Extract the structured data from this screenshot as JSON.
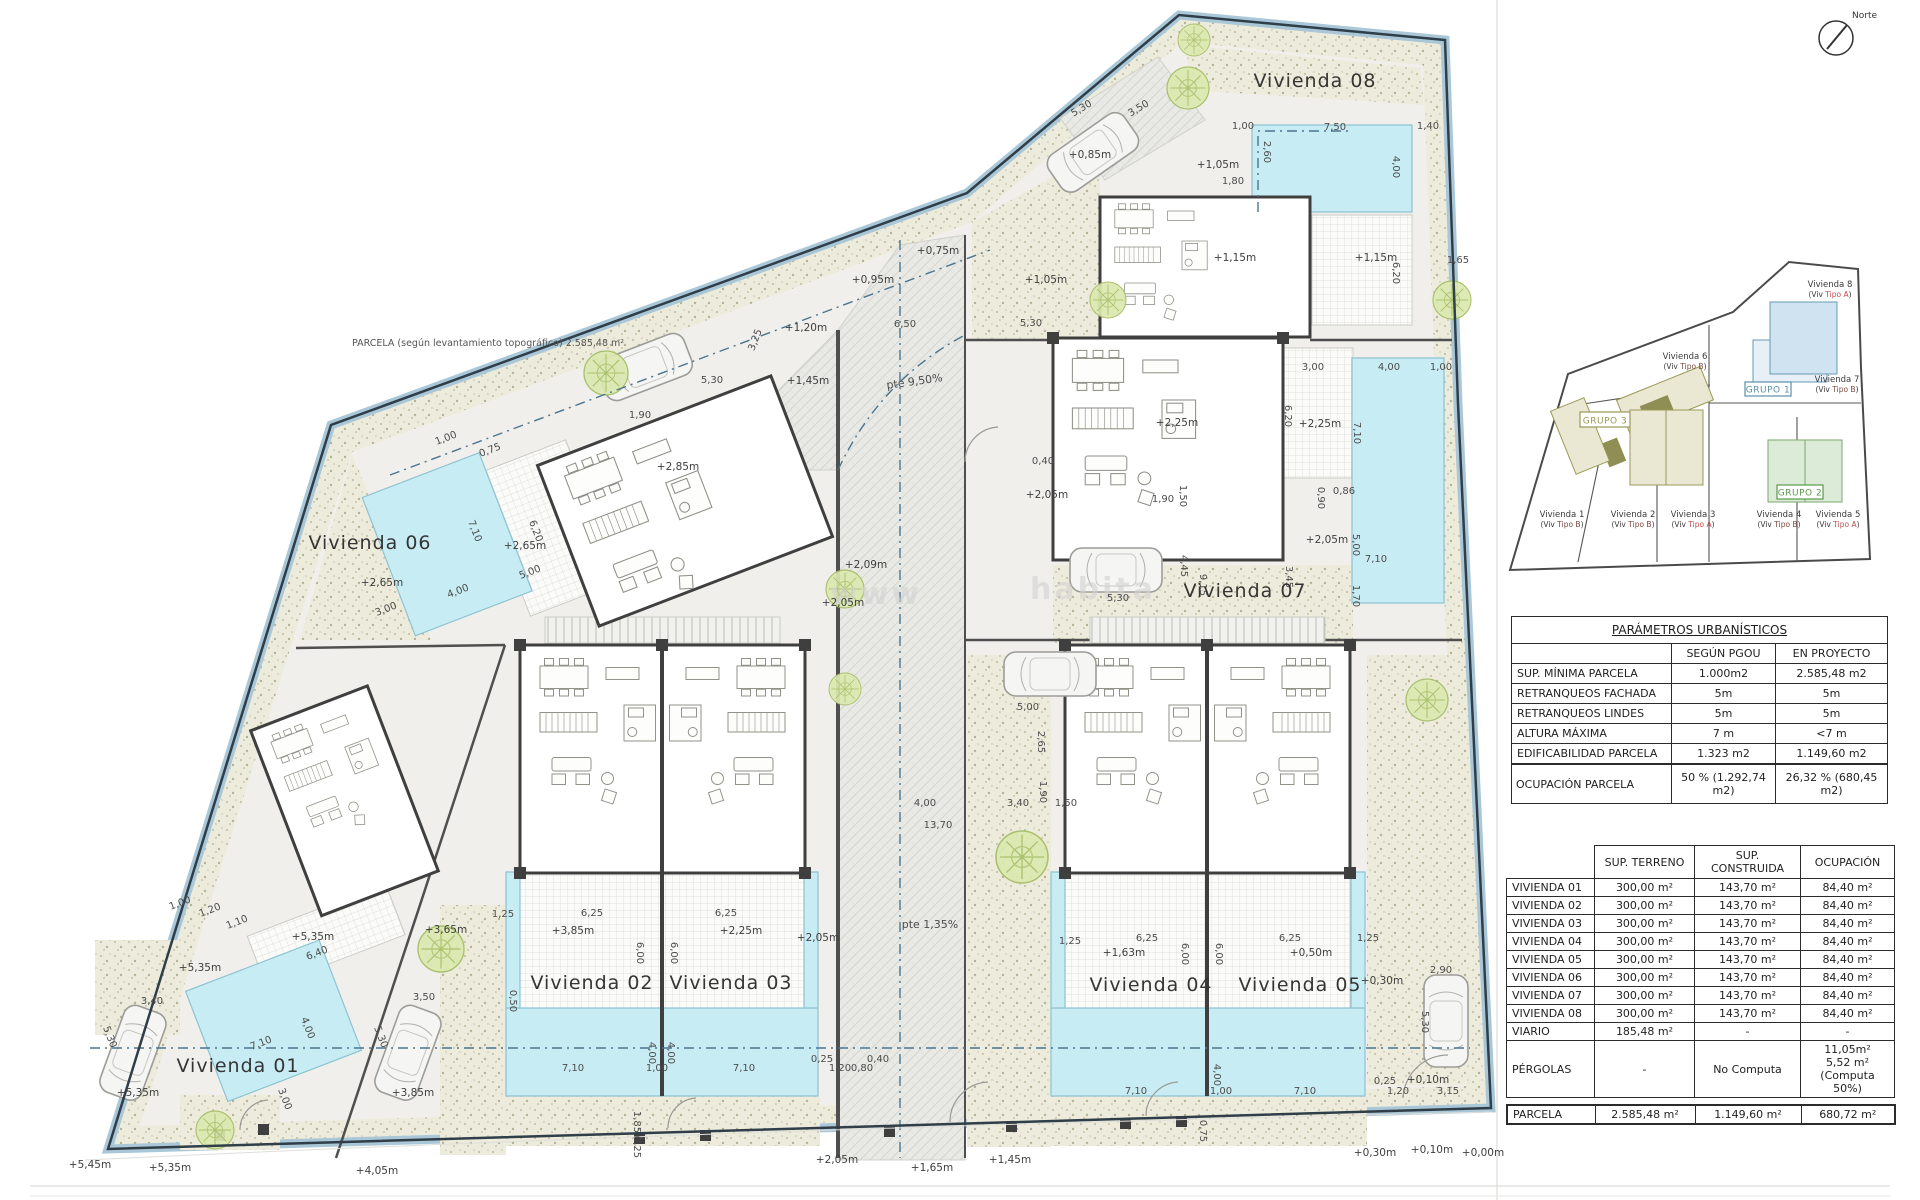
{
  "site_plan": {
    "note_parcela": "PARCELA (según levantamiento topográfico) 2.585,48 m²",
    "north_label": "Norte",
    "watermark_fragments": [
      {
        "t": "www",
        "x": 830,
        "y": 604
      },
      {
        "t": "habita",
        "x": 1030,
        "y": 599
      }
    ],
    "unit_labels": [
      {
        "t": "Vivienda 01",
        "x": 238,
        "y": 1072
      },
      {
        "t": "Vivienda 02",
        "x": 592,
        "y": 989
      },
      {
        "t": "Vivienda 03",
        "x": 731,
        "y": 989
      },
      {
        "t": "Vivienda 04",
        "x": 1151,
        "y": 991
      },
      {
        "t": "Vivienda 05",
        "x": 1300,
        "y": 991
      },
      {
        "t": "Vivienda 06",
        "x": 370,
        "y": 549
      },
      {
        "t": "Vivienda 07",
        "x": 1245,
        "y": 597
      },
      {
        "t": "Vivienda 08",
        "x": 1315,
        "y": 87
      }
    ],
    "slope_labels": [
      {
        "t": "pte 9,50%",
        "x": 915,
        "y": 385,
        "r": -8
      },
      {
        "t": "pte 1,35%",
        "x": 930,
        "y": 928
      }
    ],
    "elevation_labels": [
      {
        "t": "+2,65m",
        "x": 382,
        "y": 586
      },
      {
        "t": "+2,65m",
        "x": 525,
        "y": 549
      },
      {
        "t": "+2,85m",
        "x": 678,
        "y": 470
      },
      {
        "t": "+1,20m",
        "x": 806,
        "y": 331
      },
      {
        "t": "+1,45m",
        "x": 808,
        "y": 384
      },
      {
        "t": "+0,75m",
        "x": 938,
        "y": 254
      },
      {
        "t": "+0,95m",
        "x": 873,
        "y": 283
      },
      {
        "t": "+1,05m",
        "x": 1046,
        "y": 283
      },
      {
        "t": "+1,05m",
        "x": 1218,
        "y": 168
      },
      {
        "t": "+0,85m",
        "x": 1090,
        "y": 158
      },
      {
        "t": "+1,15m",
        "x": 1235,
        "y": 261
      },
      {
        "t": "+1,15m",
        "x": 1376,
        "y": 261
      },
      {
        "t": "+2,25m",
        "x": 1177,
        "y": 426
      },
      {
        "t": "+2,25m",
        "x": 1320,
        "y": 427
      },
      {
        "t": "+2,05m",
        "x": 1047,
        "y": 498
      },
      {
        "t": "+2,05m",
        "x": 1327,
        "y": 543
      },
      {
        "t": "+2,09m",
        "x": 866,
        "y": 568
      },
      {
        "t": "+2,05m",
        "x": 843,
        "y": 606
      },
      {
        "t": "+3,85m",
        "x": 573,
        "y": 934
      },
      {
        "t": "+2,25m",
        "x": 741,
        "y": 934
      },
      {
        "t": "+2,05m",
        "x": 818,
        "y": 941
      },
      {
        "t": "+3,65m",
        "x": 446,
        "y": 933
      },
      {
        "t": "+1,63m",
        "x": 1124,
        "y": 956
      },
      {
        "t": "+0,50m",
        "x": 1311,
        "y": 956
      },
      {
        "t": "+0,30m",
        "x": 1382,
        "y": 984
      },
      {
        "t": "+0,10m",
        "x": 1428,
        "y": 1083
      },
      {
        "t": "+0,30m",
        "x": 1375,
        "y": 1156
      },
      {
        "t": "+0,10m",
        "x": 1432,
        "y": 1153
      },
      {
        "t": "+0,00m",
        "x": 1483,
        "y": 1156
      },
      {
        "t": "+5,35m",
        "x": 200,
        "y": 971
      },
      {
        "t": "+5,35m",
        "x": 313,
        "y": 940
      },
      {
        "t": "+5,35m",
        "x": 138,
        "y": 1096
      },
      {
        "t": "+3,85m",
        "x": 413,
        "y": 1096
      },
      {
        "t": "+5,45m",
        "x": 90,
        "y": 1168
      },
      {
        "t": "+5,35m",
        "x": 170,
        "y": 1171
      },
      {
        "t": "+4,05m",
        "x": 377,
        "y": 1174
      },
      {
        "t": "+2,05m",
        "x": 837,
        "y": 1163
      },
      {
        "t": "+1,65m",
        "x": 932,
        "y": 1171
      },
      {
        "t": "+1,45m",
        "x": 1010,
        "y": 1163
      }
    ],
    "dimension_labels": [
      {
        "t": "7,10",
        "x": 472,
        "y": 532,
        "r": 69
      },
      {
        "t": "6,20",
        "x": 533,
        "y": 532,
        "r": 69
      },
      {
        "t": "4,00",
        "x": 459,
        "y": 594,
        "r": -21
      },
      {
        "t": "3,00",
        "x": 387,
        "y": 612,
        "r": -21
      },
      {
        "t": "5,00",
        "x": 531,
        "y": 575,
        "r": -21
      },
      {
        "t": "1,00",
        "x": 447,
        "y": 441,
        "r": -21
      },
      {
        "t": "0,75",
        "x": 491,
        "y": 453,
        "r": -21
      },
      {
        "t": "5,30",
        "x": 712,
        "y": 383
      },
      {
        "t": "3,25",
        "x": 758,
        "y": 341,
        "r": -69
      },
      {
        "t": "1,90",
        "x": 640,
        "y": 418
      },
      {
        "t": "6,50",
        "x": 905,
        "y": 327
      },
      {
        "t": "5,30",
        "x": 1031,
        "y": 326
      },
      {
        "t": "5,00",
        "x": 1028,
        "y": 710
      },
      {
        "t": "2,65",
        "x": 1038,
        "y": 742,
        "r": 90
      },
      {
        "t": "1,90",
        "x": 1040,
        "y": 792,
        "r": 90
      },
      {
        "t": "3,40",
        "x": 1018,
        "y": 806
      },
      {
        "t": "1,50",
        "x": 1066,
        "y": 806
      },
      {
        "t": "4,00",
        "x": 925,
        "y": 806
      },
      {
        "t": "13,70",
        "x": 938,
        "y": 828
      },
      {
        "t": "1,25",
        "x": 1070,
        "y": 944
      },
      {
        "t": "1,25",
        "x": 503,
        "y": 917
      },
      {
        "t": "6,25",
        "x": 592,
        "y": 916
      },
      {
        "t": "6,25",
        "x": 726,
        "y": 916
      },
      {
        "t": "6,00",
        "x": 637,
        "y": 953,
        "r": 90
      },
      {
        "t": "6,00",
        "x": 671,
        "y": 953,
        "r": 90
      },
      {
        "t": "0,50",
        "x": 510,
        "y": 1001,
        "r": 90
      },
      {
        "t": "7,10",
        "x": 573,
        "y": 1071
      },
      {
        "t": "7,10",
        "x": 744,
        "y": 1071
      },
      {
        "t": "1,00",
        "x": 657,
        "y": 1071
      },
      {
        "t": "4,00",
        "x": 649,
        "y": 1053,
        "r": 90
      },
      {
        "t": "4,00",
        "x": 668,
        "y": 1053,
        "r": 90
      },
      {
        "t": "0,25",
        "x": 822,
        "y": 1062
      },
      {
        "t": "1,20",
        "x": 840,
        "y": 1071
      },
      {
        "t": "0,80",
        "x": 862,
        "y": 1071
      },
      {
        "t": "0,40",
        "x": 878,
        "y": 1062
      },
      {
        "t": "1,85",
        "x": 634,
        "y": 1122,
        "r": 90
      },
      {
        "t": "0,25",
        "x": 634,
        "y": 1147,
        "r": 90
      },
      {
        "t": "6,25",
        "x": 1147,
        "y": 941
      },
      {
        "t": "6,25",
        "x": 1290,
        "y": 941
      },
      {
        "t": "1,25",
        "x": 1368,
        "y": 941
      },
      {
        "t": "6,00",
        "x": 1182,
        "y": 954,
        "r": 90
      },
      {
        "t": "6,00",
        "x": 1216,
        "y": 954,
        "r": 90
      },
      {
        "t": "7,10",
        "x": 1136,
        "y": 1094
      },
      {
        "t": "7,10",
        "x": 1305,
        "y": 1094
      },
      {
        "t": "1,00",
        "x": 1221,
        "y": 1094
      },
      {
        "t": "4,00",
        "x": 1214,
        "y": 1075,
        "r": 90
      },
      {
        "t": "0,25",
        "x": 1385,
        "y": 1084
      },
      {
        "t": "1,20",
        "x": 1398,
        "y": 1094
      },
      {
        "t": "3,15",
        "x": 1448,
        "y": 1094
      },
      {
        "t": "2,90",
        "x": 1441,
        "y": 973
      },
      {
        "t": "5,30",
        "x": 1422,
        "y": 1022,
        "r": 90
      },
      {
        "t": "0,75",
        "x": 1200,
        "y": 1131,
        "r": 90
      },
      {
        "t": "3,40",
        "x": 152,
        "y": 1004
      },
      {
        "t": "5,30",
        "x": 107,
        "y": 1038,
        "r": 69
      },
      {
        "t": "5,30",
        "x": 378,
        "y": 1038,
        "r": 69
      },
      {
        "t": "3,50",
        "x": 424,
        "y": 1000
      },
      {
        "t": "7,10",
        "x": 262,
        "y": 1046,
        "r": -21
      },
      {
        "t": "4,00",
        "x": 305,
        "y": 1029,
        "r": 69
      },
      {
        "t": "3,00",
        "x": 282,
        "y": 1100,
        "r": 69
      },
      {
        "t": "6,40",
        "x": 318,
        "y": 956,
        "r": -21
      },
      {
        "t": "1,20",
        "x": 211,
        "y": 913,
        "r": -21
      },
      {
        "t": "1,00",
        "x": 181,
        "y": 906,
        "r": -21
      },
      {
        "t": "1,10",
        "x": 238,
        "y": 925,
        "r": -21
      },
      {
        "t": "3,00",
        "x": 1313,
        "y": 370
      },
      {
        "t": "4,00",
        "x": 1389,
        "y": 370
      },
      {
        "t": "1,00",
        "x": 1441,
        "y": 370
      },
      {
        "t": "6,20",
        "x": 1285,
        "y": 416,
        "r": 90
      },
      {
        "t": "7,10",
        "x": 1354,
        "y": 433,
        "r": 90
      },
      {
        "t": "0,40",
        "x": 1043,
        "y": 464
      },
      {
        "t": "1,90",
        "x": 1163,
        "y": 502
      },
      {
        "t": "1,50",
        "x": 1180,
        "y": 496,
        "r": 90
      },
      {
        "t": "0,90",
        "x": 1318,
        "y": 498,
        "r": 90
      },
      {
        "t": "0,86",
        "x": 1344,
        "y": 494
      },
      {
        "t": "5,00",
        "x": 1353,
        "y": 545,
        "r": 90
      },
      {
        "t": "7,10",
        "x": 1376,
        "y": 562
      },
      {
        "t": "4,45",
        "x": 1181,
        "y": 566,
        "r": 90
      },
      {
        "t": "9,15",
        "x": 1200,
        "y": 585,
        "r": 90
      },
      {
        "t": "3,45",
        "x": 1286,
        "y": 577,
        "r": 90
      },
      {
        "t": "5,30",
        "x": 1118,
        "y": 601
      },
      {
        "t": "1,70",
        "x": 1353,
        "y": 596,
        "r": 90
      },
      {
        "t": "5,30",
        "x": 1083,
        "y": 111,
        "r": -31
      },
      {
        "t": "3,50",
        "x": 1140,
        "y": 111,
        "r": -31
      },
      {
        "t": "1,00",
        "x": 1243,
        "y": 129
      },
      {
        "t": "7,50",
        "x": 1335,
        "y": 130
      },
      {
        "t": "1,40",
        "x": 1428,
        "y": 129
      },
      {
        "t": "2,60",
        "x": 1264,
        "y": 152,
        "r": 90
      },
      {
        "t": "4,00",
        "x": 1393,
        "y": 167,
        "r": 90
      },
      {
        "t": "1,80",
        "x": 1233,
        "y": 184
      },
      {
        "t": "6,20",
        "x": 1393,
        "y": 273,
        "r": 90
      },
      {
        "t": "1,65",
        "x": 1458,
        "y": 263
      }
    ]
  },
  "key_plan": {
    "tipo_a_color": "#c0504d",
    "tipo_b_color": "#7a4a42",
    "groups": [
      {
        "label": "GRUPO 1",
        "x": 245,
        "y": 130,
        "w": 46,
        "h": 14,
        "color": "#5b8fa8"
      },
      {
        "label": "GRUPO 2",
        "x": 277,
        "y": 233,
        "w": 46,
        "h": 14,
        "color": "#589a4a"
      },
      {
        "label": "GRUPO 3",
        "x": 80,
        "y": 160,
        "w": 50,
        "h": 15,
        "color": "#9a9a57"
      }
    ],
    "units": [
      {
        "name": "Vivienda 1",
        "tipo": "Tipo B",
        "x": 62,
        "y": 265
      },
      {
        "name": "Vivienda 2",
        "tipo": "Tipo B",
        "x": 133,
        "y": 265
      },
      {
        "name": "Vivienda 3",
        "tipo": "Tipo A",
        "x": 193,
        "y": 265
      },
      {
        "name": "Vivienda 4",
        "tipo": "Tipo B",
        "x": 279,
        "y": 265
      },
      {
        "name": "Vivienda 5",
        "tipo": "Tipo A",
        "x": 338,
        "y": 265
      },
      {
        "name": "Vivienda 6",
        "tipo": "Tipo B",
        "x": 185,
        "y": 107
      },
      {
        "name": "Vivienda 7",
        "tipo": "Tipo B",
        "x": 337,
        "y": 130
      },
      {
        "name": "Vivienda 8",
        "tipo": "Tipo A",
        "x": 330,
        "y": 35
      }
    ]
  },
  "params_table": {
    "title": "PARÁMETROS URBANÍSTICOS",
    "col_headers": [
      "SEGÚN PGOU",
      "EN PROYECTO"
    ],
    "rows": [
      [
        "SUP. MÍNIMA PARCELA",
        "1.000m2",
        "2.585,48 m2"
      ],
      [
        "RETRANQUEOS FACHADA",
        "5m",
        "5m"
      ],
      [
        "RETRANQUEOS LINDES",
        "5m",
        "5m"
      ],
      [
        "ALTURA MÁXIMA",
        "7 m",
        "<7 m"
      ],
      [
        "EDIFICABILIDAD PARCELA",
        "1.323 m2",
        "1.149,60 m2"
      ]
    ],
    "footer_rows": [
      [
        "OCUPACIÓN PARCELA",
        "50 % (1.292,74 m2)",
        "26,32 % (680,45 m2)"
      ]
    ]
  },
  "areas_table": {
    "col_headers": [
      "SUP. TERRENO",
      "SUP. CONSTRUIDA",
      "OCUPACIÓN"
    ],
    "rows": [
      [
        "VIVIENDA 01",
        "300,00 m²",
        "143,70 m²",
        "84,40 m²"
      ],
      [
        "VIVIENDA 02",
        "300,00 m²",
        "143,70 m²",
        "84,40 m²"
      ],
      [
        "VIVIENDA 03",
        "300,00 m²",
        "143,70 m²",
        "84,40 m²"
      ],
      [
        "VIVIENDA 04",
        "300,00 m²",
        "143,70 m²",
        "84,40 m²"
      ],
      [
        "VIVIENDA 05",
        "300,00 m²",
        "143,70 m²",
        "84,40 m²"
      ],
      [
        "VIVIENDA 06",
        "300,00 m²",
        "143,70 m²",
        "84,40 m²"
      ],
      [
        "VIVIENDA 07",
        "300,00 m²",
        "143,70 m²",
        "84,40 m²"
      ],
      [
        "VIVIENDA 08",
        "300,00 m²",
        "143,70 m²",
        "84,40 m²"
      ],
      [
        "VIARIO",
        "185,48 m²",
        "-",
        "-"
      ],
      [
        "PÉRGOLAS",
        "-",
        "No Computa",
        "11,05m²\n5,52 m² (Computa 50%)"
      ]
    ],
    "total_rows": [
      [
        "PARCELA",
        "2.585,48 m²",
        "1.149,60 m²",
        "680,72 m²"
      ]
    ]
  }
}
